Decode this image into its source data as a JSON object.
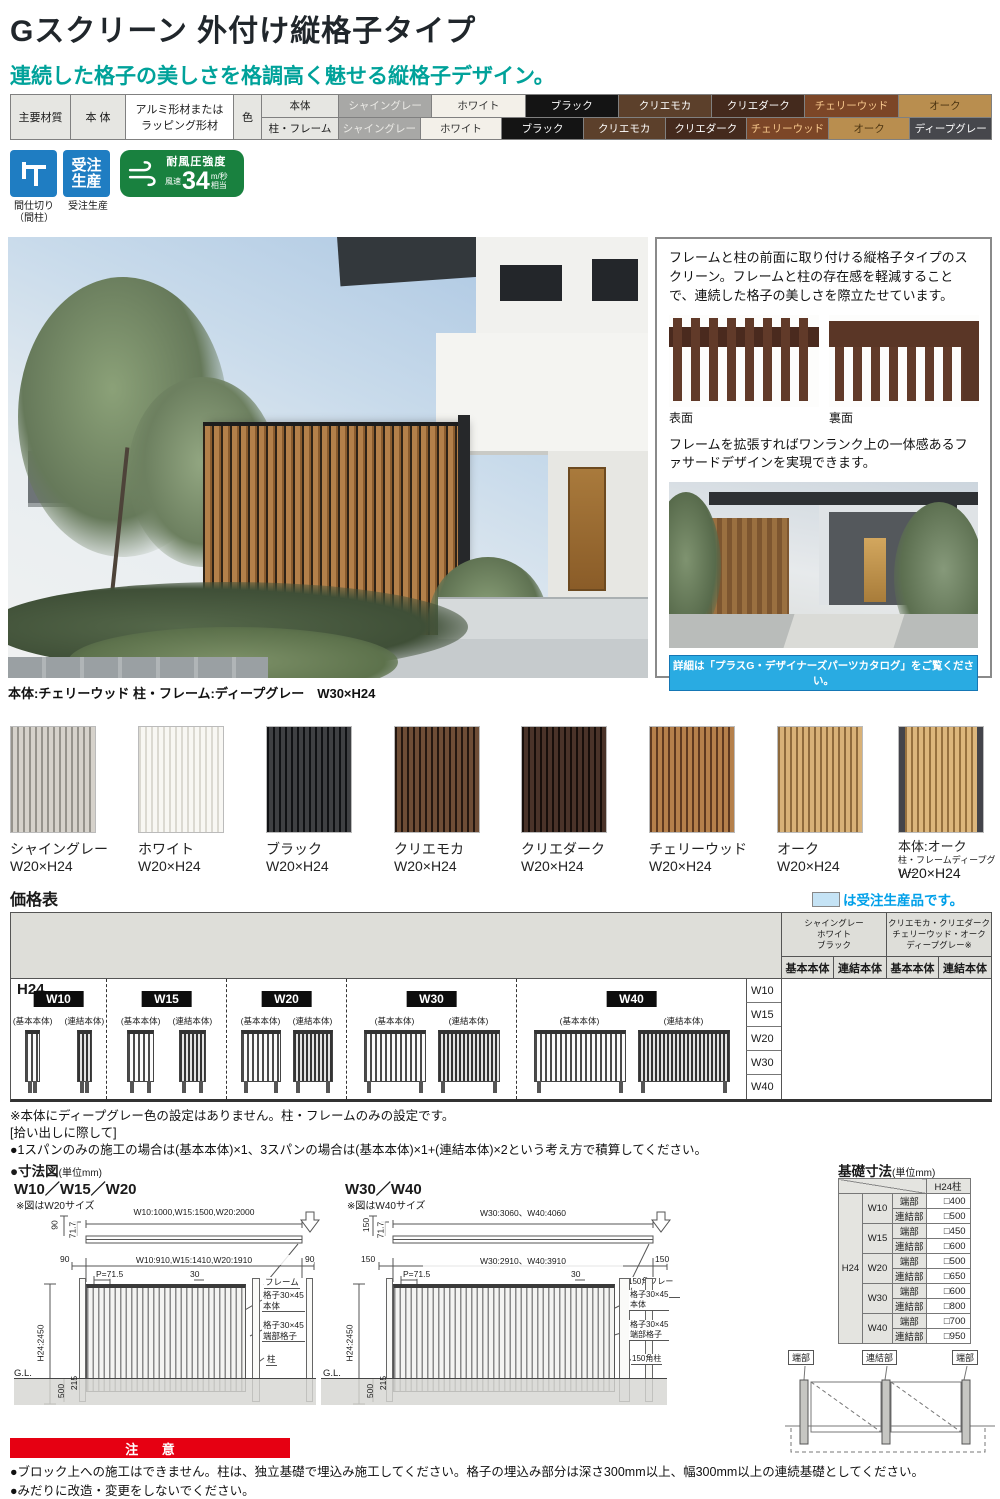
{
  "header": {
    "title": "Gスクリーン 外付け縦格子タイプ",
    "subtitle": "連続した格子の美しさを格調高く魅せる縦格子デザイン。"
  },
  "spec": {
    "material_label": "主要材質",
    "target_label": "本 体",
    "material_value": "アルミ形材または\nラッピング形材",
    "color_label": "色",
    "row1_label": "本体",
    "row2_label": "柱・フレーム",
    "row1": [
      {
        "name": "シャイングレー",
        "bg": "#a8a8a6",
        "fg": "#ecebe7"
      },
      {
        "name": "ホワイト",
        "bg": "#f3f0e9",
        "fg": "#333333"
      },
      {
        "name": "ブラック",
        "bg": "#141414",
        "fg": "#ffffff"
      },
      {
        "name": "クリエモカ",
        "bg": "#5c402b",
        "fg": "#ffffff"
      },
      {
        "name": "クリエダーク",
        "bg": "#442a1d",
        "fg": "#ffffff"
      },
      {
        "name": "チェリーウッド",
        "bg": "#7c4627",
        "fg": "#f8c98e"
      },
      {
        "name": "オーク",
        "bg": "#b98e4f",
        "fg": "#4a3310"
      }
    ],
    "row2": [
      {
        "name": "シャイングレー",
        "bg": "#a8a8a6",
        "fg": "#ecebe7"
      },
      {
        "name": "ホワイト",
        "bg": "#f3f0e9",
        "fg": "#333333"
      },
      {
        "name": "ブラック",
        "bg": "#141414",
        "fg": "#ffffff"
      },
      {
        "name": "クリエモカ",
        "bg": "#5c402b",
        "fg": "#ffffff"
      },
      {
        "name": "クリエダーク",
        "bg": "#442a1d",
        "fg": "#ffffff"
      },
      {
        "name": "チェリーウッド",
        "bg": "#7c4627",
        "fg": "#f8c98e"
      },
      {
        "name": "オーク",
        "bg": "#b98e4f",
        "fg": "#4a3310"
      },
      {
        "name": "ディープグレー",
        "bg": "#46474c",
        "fg": "#ffffff"
      }
    ]
  },
  "badges": {
    "partition_caption": "間仕切り\n（間柱）",
    "order_line1": "受注",
    "order_line2": "生産",
    "order_caption": "受注生産",
    "wind_title": "耐風圧強度",
    "wind_prefix": "風速",
    "wind_value": "34",
    "wind_unit_top": "m/秒",
    "wind_unit_bottom": "相当"
  },
  "photo_caption": "本体:チェリーウッド 柱・フレーム:ディープグレー　W30×H24",
  "panel": {
    "para1": "フレームと柱の前面に取り付ける縦格子タイプのスクリーン。フレームと柱の存在感を軽減することで、連続した格子の美しさを際立たせています。",
    "thumb1": "表面",
    "thumb2": "裏面",
    "para2": "フレームを拡張すればワンランク上の一体感あるファサードデザインを実現できます。",
    "banner": "詳細は「プラスG・デザイナーズパーツカタログ」をご覧ください。"
  },
  "swatches": [
    {
      "name": "シャイングレー",
      "size": "W20×H24",
      "base": "#d6d2cb",
      "stripe": "#96938c"
    },
    {
      "name": "ホワイト",
      "size": "W20×H24",
      "base": "#f8f7f3",
      "stripe": "#dbd9d1"
    },
    {
      "name": "ブラック",
      "size": "W20×H24",
      "base": "#3f4043",
      "stripe": "#101114"
    },
    {
      "name": "クリエモカ",
      "size": "W20×H24",
      "base": "#6e4d36",
      "stripe": "#241710"
    },
    {
      "name": "クリエダーク",
      "size": "W20×H24",
      "base": "#4a3329",
      "stripe": "#170e0a"
    },
    {
      "name": "チェリーウッド",
      "size": "W20×H24",
      "base": "#b5804b",
      "stripe": "#5f3a20"
    },
    {
      "name": "オーク",
      "size": "W20×H24",
      "base": "#d8b177",
      "stripe": "#8e6a3c"
    },
    {
      "name": "本体:オーク",
      "sub": "柱・フレームディープグレー",
      "size": "W20×H24",
      "base": "#dcb67c",
      "stripe": "#96713f"
    }
  ],
  "price": {
    "title": "価格表",
    "legend": "は受注生産品です。",
    "group1": "シャイングレー\nホワイト\nブラック",
    "group2": "クリエモカ・クリエダーク\nチェリーウッド・オーク\nディープグレー※",
    "subcols": [
      "基本本体",
      "連結本体",
      "基本本体",
      "連結本体"
    ],
    "h_label": "H24",
    "rows": [
      "W10",
      "W15",
      "W20",
      "W30",
      "W40"
    ],
    "groups": [
      {
        "badge": "W10",
        "basic": "(基本本体)",
        "joint": "(連結本体)"
      },
      {
        "badge": "W15",
        "basic": "(基本本体)",
        "joint": "(連結本体)"
      },
      {
        "badge": "W20",
        "basic": "(基本本体)",
        "joint": "(連結本体)"
      },
      {
        "badge": "W30",
        "basic": "(基本本体)",
        "joint": "(連結本体)"
      },
      {
        "badge": "W40",
        "basic": "(基本本体)",
        "joint": "(連結本体)"
      }
    ]
  },
  "notes": {
    "n1": "※本体にディープグレー色の設定はありません。柱・フレームのみの設定です。",
    "n2": "[拾い出しに際して]",
    "n3": "●1スパンのみの施工の場合は(基本本体)×1、3スパンの場合は(基本本体)×1+(連結本体)×2という考え方で積算してください。"
  },
  "dim_section": {
    "title": "●寸法図",
    "unit": "(単位mm)"
  },
  "drawing1": {
    "title": "W10／W15／W20",
    "note": "※図はW20サイズ",
    "top_dim": "W10:1000,W15:1500,W20:2000",
    "dim_a": "90",
    "dim_b": "71.7",
    "side_l": "90",
    "side_r": "90",
    "mid_dim": "W10:910,W15:1410,W20:1910",
    "pitch": "P=71.5",
    "offset": "30",
    "frame": "フレーム",
    "lbl1": "格子30×45\n本体",
    "lbl2": "格子30×45\n端部格子",
    "lbl3": "柱",
    "height": "H24:2450",
    "gl": "G.L.",
    "d215": "215",
    "d500": "500"
  },
  "drawing2": {
    "title": "W30／W40",
    "note": "※図はW40サイズ",
    "top_dim": "W30:3060、W40:4060",
    "dim_a": "150",
    "dim_b": "71.7",
    "side_l": "150",
    "side_r": "150",
    "mid_dim": "W30:2910、W40:3910",
    "pitch": "P=71.5",
    "offset": "30",
    "frame": "150角フレーム",
    "lbl1": "格子30×45\n本体",
    "lbl2": "格子30×45\n端部格子",
    "lbl3": "150角柱",
    "height": "H24:2450",
    "gl": "G.L.",
    "d215": "215",
    "d500": "500"
  },
  "foundation": {
    "title": "基礎寸法",
    "unit": "(単位mm)",
    "col_header": "H24柱",
    "row_header": "H24",
    "rows": [
      {
        "w": "W10",
        "edge_label": "端部",
        "edge": "□400",
        "joint_label": "連結部",
        "joint": "□500"
      },
      {
        "w": "W15",
        "edge_label": "端部",
        "edge": "□450",
        "joint_label": "連結部",
        "joint": "□600"
      },
      {
        "w": "W20",
        "edge_label": "端部",
        "edge": "□500",
        "joint_label": "連結部",
        "joint": "□650"
      },
      {
        "w": "W30",
        "edge_label": "端部",
        "edge": "□600",
        "joint_label": "連結部",
        "joint": "□800"
      },
      {
        "w": "W40",
        "edge_label": "端部",
        "edge": "□700",
        "joint_label": "連結部",
        "joint": "□950"
      }
    ],
    "diag": [
      "端部",
      "連結部",
      "端部"
    ]
  },
  "caution": {
    "title": "注 意",
    "line1": "●ブロック上への施工はできません。柱は、独立基礎で埋込み施工してください。格子の埋込み部分は深さ300mm以上、幅300mm以上の連続基礎としてください。",
    "line2": "●みだりに改造・変更をしないでください。"
  }
}
